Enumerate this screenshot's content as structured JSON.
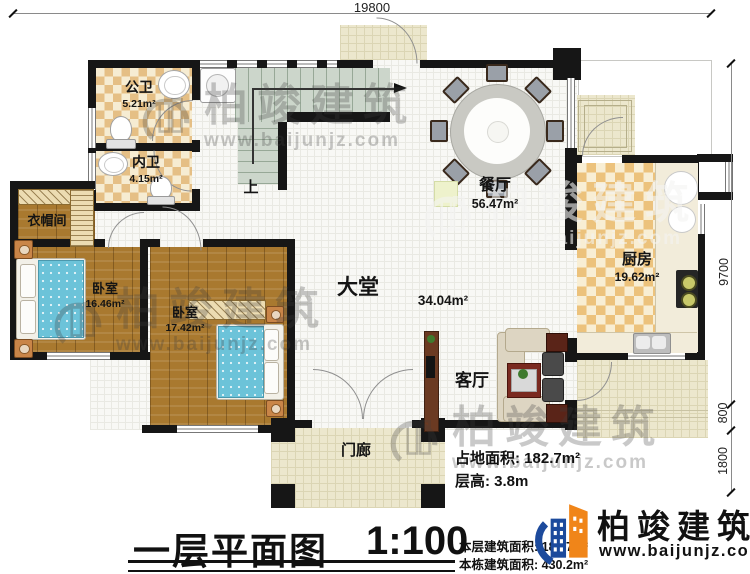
{
  "dimensions": {
    "top": "19800",
    "right_total": "9700",
    "right_mid": "800",
    "right_low": "1800"
  },
  "rooms": {
    "public_bath": {
      "name": "公卫",
      "area": "5.21m²"
    },
    "inner_bath": {
      "name": "内卫",
      "area": "4.15m²"
    },
    "cloakroom": {
      "name": "衣帽间"
    },
    "bedroom1": {
      "name": "卧室",
      "area": "16.46m²"
    },
    "bedroom2": {
      "name": "卧室",
      "area": "17.42m²"
    },
    "hall": {
      "name": "大堂",
      "area": "34.04m²"
    },
    "dining": {
      "name": "餐厅",
      "area": "56.47m²"
    },
    "kitchen": {
      "name": "厨房",
      "area": "19.62m²"
    },
    "living": {
      "name": "客厅"
    },
    "porch": {
      "name": "门廊"
    },
    "stair_direction": "上"
  },
  "notes": {
    "site_area_label": "占地面积:",
    "site_area_value": "182.7m²",
    "floor_height_label": "层高:",
    "floor_height_value": "3.8m"
  },
  "title_block": {
    "title": "一层平面图",
    "scale": "1:100",
    "floor_area_label": "本层建筑面积:",
    "floor_area_value": "182.7m²",
    "total_area_label": "本栋建筑面积:",
    "total_area_value": "430.2m²"
  },
  "brand": {
    "name": "柏竣建筑",
    "website": "www.baijunjz.com"
  },
  "watermark": {
    "name": "柏竣建筑",
    "website": "www.baijunjz.com"
  },
  "colors": {
    "wall": "#161616",
    "brand_blue": "#1c4a9c",
    "brand_orange": "#f08519"
  }
}
